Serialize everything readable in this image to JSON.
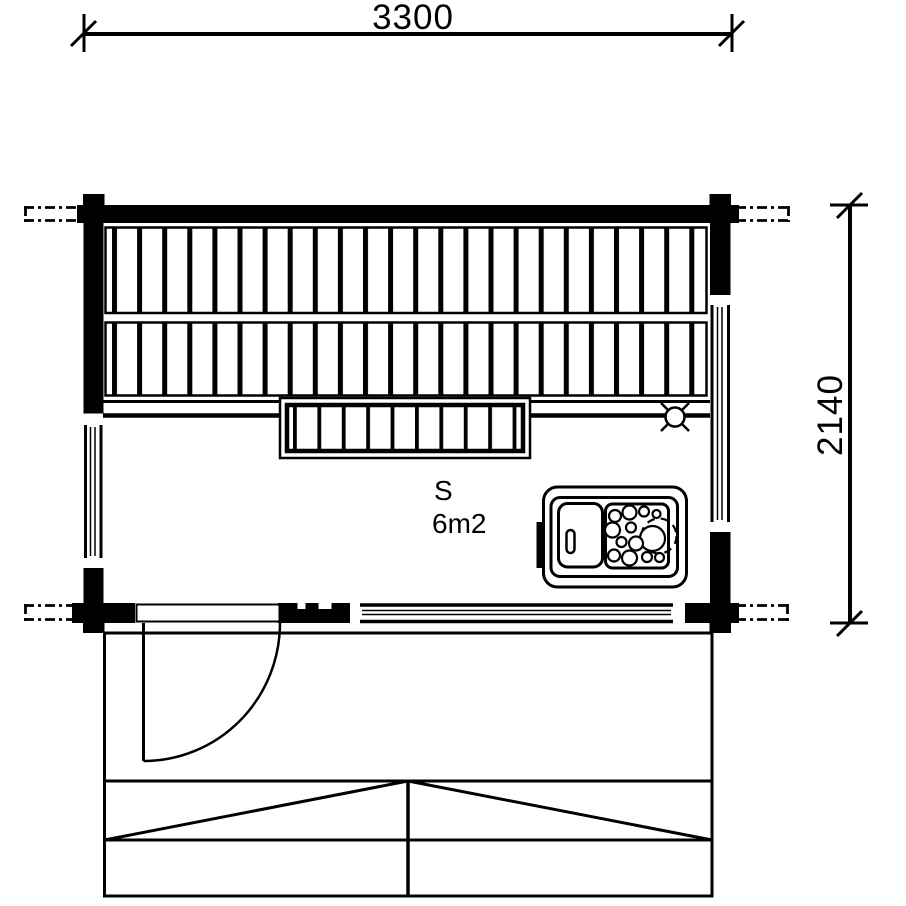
{
  "drawing": {
    "kind": "sauna-floor-plan",
    "ink_color": "#000000",
    "paper_color": "#ffffff"
  },
  "dimensions": {
    "top": {
      "label": "3300"
    },
    "right": {
      "label": "2140"
    }
  },
  "room": {
    "label": "S",
    "area_label": "6m2"
  },
  "icons": {
    "light": "light-point-icon",
    "heater": "sauna-heater-icon",
    "door": "door-swing-icon"
  }
}
